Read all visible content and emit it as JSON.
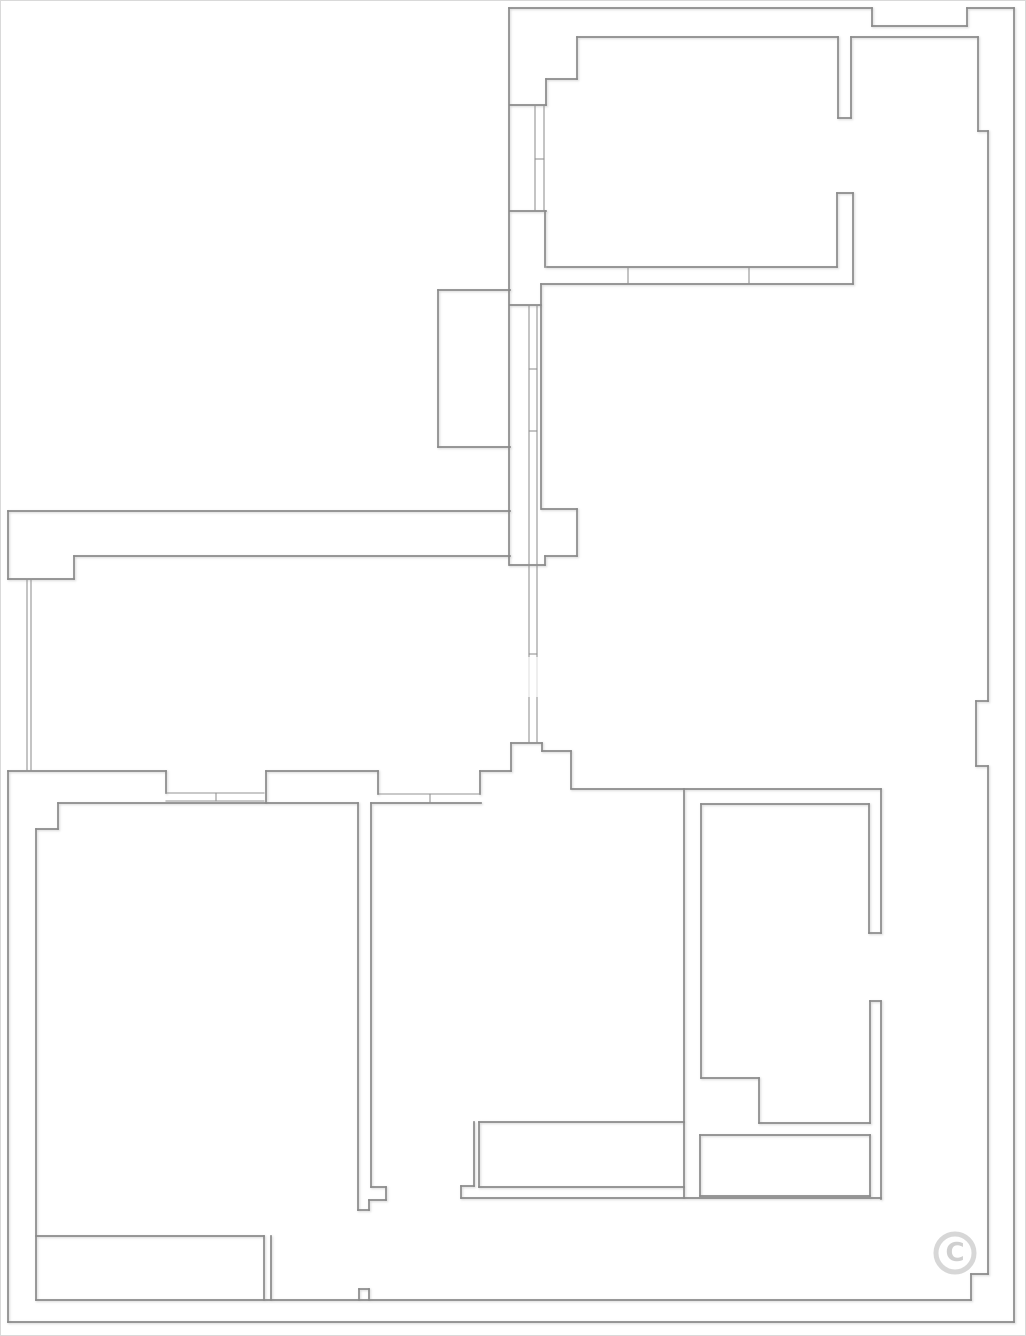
{
  "meta": {
    "kind": "architectural-floor-plan",
    "description": "Black-and-white apartment floor plan line drawing with walls, window glazing lines, door openings, a balcony and a copyright watermark"
  },
  "canvas": {
    "width": 1026,
    "height": 1336,
    "background": "#ffffff",
    "border_color": "#d9d9d9"
  },
  "plan": {
    "stroke_color": "#8a8a8a",
    "stroke_width": 1.7,
    "thin_stroke_color": "#939393",
    "thin_stroke_width": 1.1,
    "segments": [
      [
        508,
        7,
        871,
        7
      ],
      [
        871,
        7,
        871,
        25
      ],
      [
        871,
        25,
        966,
        25
      ],
      [
        966,
        25,
        966,
        7
      ],
      [
        966,
        7,
        1013,
        7
      ],
      [
        1013,
        7,
        1013,
        1321
      ],
      [
        1013,
        1321,
        7,
        1321
      ],
      [
        7,
        1321,
        7,
        770
      ],
      [
        7,
        578,
        7,
        510
      ],
      [
        508,
        7,
        508,
        564
      ],
      [
        576,
        36,
        837,
        36
      ],
      [
        576,
        36,
        576,
        78
      ],
      [
        545,
        78,
        576,
        78
      ],
      [
        545,
        78,
        545,
        104
      ],
      [
        509,
        104,
        545,
        104
      ],
      [
        509,
        210,
        545,
        210
      ],
      [
        544,
        210,
        544,
        266
      ],
      [
        850,
        36,
        977,
        36
      ],
      [
        837,
        36,
        837,
        117
      ],
      [
        850,
        36,
        850,
        117
      ],
      [
        837,
        117,
        850,
        117
      ],
      [
        836,
        192,
        836,
        266
      ],
      [
        852,
        192,
        852,
        283
      ],
      [
        836,
        192,
        852,
        192
      ],
      [
        546,
        266,
        836,
        266
      ],
      [
        540,
        283,
        852,
        283
      ],
      [
        977,
        36,
        977,
        130
      ],
      [
        977,
        130,
        987,
        130
      ],
      [
        987,
        130,
        987,
        700
      ],
      [
        975,
        700,
        987,
        700
      ],
      [
        975,
        700,
        975,
        765
      ],
      [
        975,
        765,
        987,
        765
      ],
      [
        987,
        765,
        987,
        1273
      ],
      [
        970,
        1273,
        987,
        1273
      ],
      [
        970,
        1273,
        970,
        1299
      ],
      [
        35,
        1299,
        970,
        1299
      ],
      [
        437,
        289,
        437,
        446
      ],
      [
        437,
        289,
        509,
        289
      ],
      [
        437,
        446,
        509,
        446
      ],
      [
        540,
        283,
        540,
        508
      ],
      [
        509,
        304,
        540,
        304
      ],
      [
        541,
        508,
        576,
        508
      ],
      [
        576,
        508,
        576,
        555
      ],
      [
        544,
        555,
        576,
        555
      ],
      [
        544,
        555,
        544,
        564
      ],
      [
        509,
        564,
        544,
        564
      ],
      [
        7,
        510,
        509,
        510
      ],
      [
        73,
        555,
        509,
        555
      ],
      [
        73,
        555,
        73,
        578
      ],
      [
        7,
        578,
        73,
        578
      ],
      [
        510,
        742,
        541,
        742
      ],
      [
        510,
        742,
        510,
        770
      ],
      [
        541,
        742,
        541,
        750
      ],
      [
        541,
        750,
        570,
        750
      ],
      [
        570,
        750,
        570,
        787
      ],
      [
        479,
        770,
        510,
        770
      ],
      [
        479,
        770,
        479,
        793
      ],
      [
        570,
        788,
        880,
        788
      ],
      [
        7,
        770,
        165,
        770
      ],
      [
        165,
        770,
        165,
        792
      ],
      [
        265,
        770,
        265,
        802
      ],
      [
        265,
        770,
        377,
        770
      ],
      [
        377,
        770,
        377,
        793
      ],
      [
        57,
        802,
        357,
        802
      ],
      [
        57,
        802,
        57,
        828
      ],
      [
        35,
        828,
        57,
        828
      ],
      [
        35,
        828,
        35,
        1299
      ],
      [
        35,
        1235,
        263,
        1235
      ],
      [
        263,
        1235,
        263,
        1299
      ],
      [
        270,
        1235,
        270,
        1299
      ],
      [
        358,
        1288,
        368,
        1288
      ],
      [
        358,
        1288,
        358,
        1299
      ],
      [
        368,
        1288,
        368,
        1299
      ],
      [
        357,
        802,
        357,
        1209
      ],
      [
        370,
        802,
        370,
        1186
      ],
      [
        370,
        1186,
        385,
        1186
      ],
      [
        385,
        1186,
        385,
        1199
      ],
      [
        368,
        1199,
        385,
        1199
      ],
      [
        368,
        1199,
        368,
        1209
      ],
      [
        357,
        1209,
        368,
        1209
      ],
      [
        370,
        802,
        480,
        802
      ],
      [
        478,
        1121,
        683,
        1121
      ],
      [
        473,
        1121,
        473,
        1185
      ],
      [
        478,
        1121,
        478,
        1186
      ],
      [
        460,
        1185,
        473,
        1185
      ],
      [
        460,
        1185,
        460,
        1197
      ],
      [
        478,
        1186,
        683,
        1186
      ],
      [
        460,
        1197,
        880,
        1197
      ],
      [
        683,
        788,
        683,
        1197
      ],
      [
        700,
        803,
        700,
        1077
      ],
      [
        700,
        803,
        868,
        803
      ],
      [
        700,
        1077,
        758,
        1077
      ],
      [
        758,
        1077,
        758,
        1122
      ],
      [
        758,
        1122,
        869,
        1122
      ],
      [
        868,
        803,
        868,
        932
      ],
      [
        880,
        788,
        880,
        932
      ],
      [
        868,
        932,
        880,
        932
      ],
      [
        869,
        1000,
        869,
        1122
      ],
      [
        880,
        1000,
        880,
        1198
      ],
      [
        869,
        1000,
        880,
        1000
      ],
      [
        699,
        1134,
        869,
        1134
      ],
      [
        699,
        1134,
        699,
        1195
      ],
      [
        699,
        1195,
        869,
        1195
      ],
      [
        869,
        1134,
        869,
        1195
      ]
    ],
    "thin_segments": [
      [
        534,
        104,
        534,
        210
      ],
      [
        543,
        104,
        543,
        210
      ],
      [
        534,
        158,
        543,
        158
      ],
      [
        528,
        304,
        528,
        742
      ],
      [
        536,
        304,
        536,
        742
      ],
      [
        528,
        368,
        536,
        368
      ],
      [
        528,
        430,
        536,
        430
      ],
      [
        528,
        653,
        536,
        653
      ],
      [
        26,
        578,
        26,
        770
      ],
      [
        30,
        578,
        30,
        770
      ],
      [
        165,
        792,
        263,
        792
      ],
      [
        165,
        800,
        263,
        800
      ],
      [
        215,
        792,
        215,
        800
      ],
      [
        378,
        793,
        479,
        793
      ],
      [
        429,
        793,
        429,
        802
      ],
      [
        627,
        266,
        627,
        283
      ],
      [
        748,
        266,
        748,
        283
      ]
    ]
  },
  "watermarks": {
    "copyright": {
      "symbol": "©",
      "cx": 954,
      "cy": 1252,
      "outer_radius": 19,
      "ring_color": "#d7d7d7",
      "glyph_color": "#cfcfcf"
    },
    "smudge": {
      "x": 522,
      "y": 656,
      "width": 28,
      "height": 40,
      "color": "#ffffff",
      "opacity": 0.72
    }
  }
}
